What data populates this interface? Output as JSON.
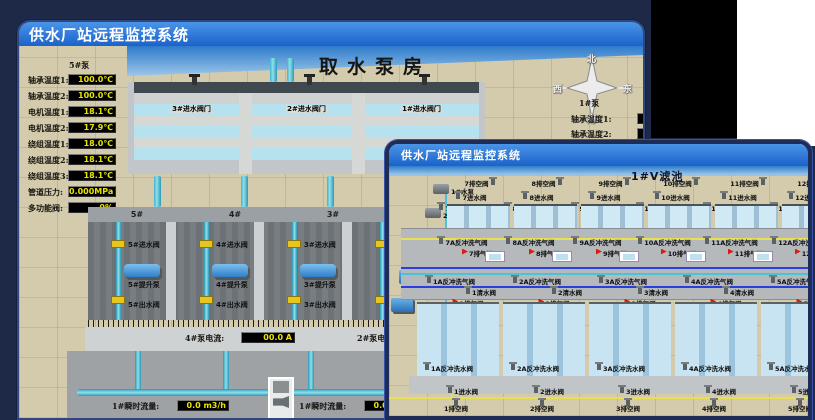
{
  "colors": {
    "page_bg": "#1e2948",
    "corner_black": "#000000",
    "corner_white": "#ffffff",
    "titlebar_top": "#4a94e8",
    "titlebar_bottom": "#1b63c9",
    "title_text": "#ffffff",
    "sand": "#d3cbac",
    "sky_top": "#2e7bca",
    "sky_bottom": "#9cc6e8",
    "value_text": "#e8e400",
    "value_bg": "#000000",
    "pipe_cyan": "#49c2da",
    "valve_yellow": "#e6c51e",
    "pump_blue": "#2f7fc8",
    "exhaust_red": "#dd1a0e",
    "water": "#cfe9f5",
    "gallery_gray": "#b5b9bc",
    "pipe_yellow": "#e8e050",
    "pipe_blue": "#2a3ee0"
  },
  "window_back": {
    "title": "供水厂站远程监控系统",
    "scene_title": "取水泵房",
    "panel": {
      "header": "5#泵",
      "rows": [
        {
          "label": "轴承温度1:",
          "value": "100.0℃"
        },
        {
          "label": "轴承温度2:",
          "value": "100.0℃"
        },
        {
          "label": "电机温度1:",
          "value": "18.1℃"
        },
        {
          "label": "电机温度2:",
          "value": "17.9℃"
        },
        {
          "label": "绕组温度1:",
          "value": "18.0℃"
        },
        {
          "label": "绕组温度2:",
          "value": "18.1℃"
        },
        {
          "label": "绕组温度3:",
          "value": "18.1℃"
        },
        {
          "label": "管道压力:",
          "value": "0.000MPa"
        },
        {
          "label": "多功能阀:",
          "value": "0%"
        }
      ]
    },
    "partial_panel": {
      "header": "1#泵",
      "rows": [
        "轴承温度1:",
        "轴承温度2:"
      ]
    },
    "compass": {
      "n": "北",
      "w": "西",
      "s": "南",
      "e": "东"
    },
    "inlet_valve_labels": [
      "3#进水阀门",
      "2#进水阀门",
      "1#进水阀门"
    ],
    "bays": [
      {
        "no": "5#",
        "inlet": "5#进水阀",
        "pump": "5#提升泵",
        "outlet": "5#出水阀"
      },
      {
        "no": "4#",
        "inlet": "4#进水阀",
        "pump": "4#提升泵",
        "outlet": "4#出水阀"
      },
      {
        "no": "3#",
        "inlet": "3#进水阀",
        "pump": "3#提升泵",
        "outlet": "3#出水阀"
      },
      {
        "no": "2#",
        "inlet": "2#进水阀",
        "pump": "2#提升泵",
        "outlet": "2#出水阀"
      }
    ],
    "current_left": {
      "label": "4#泵电流:",
      "value": "00.0 A"
    },
    "current_right": {
      "label": "2#泵电流:",
      "value": "00.0 A"
    },
    "flow_left": {
      "label": "1#瞬时流量:",
      "value": "0.0 m3/h"
    },
    "flow_right": {
      "label": "1#瞬时流量:",
      "value": "0.0 m3/h"
    }
  },
  "window_front": {
    "title": "供水厂站远程监控系统",
    "scene_title": "1#V滤池",
    "equipment_pumps": [
      "1#水泵",
      "2#水泵",
      "3#水泵"
    ],
    "equipment_fans": [
      "1#风机",
      "2#风机",
      "3#风机"
    ],
    "far_drain": [
      "7排空阀",
      "8排空阀",
      "9排空阀",
      "10排空阀",
      "11排空阀",
      "12排空阀"
    ],
    "far_inlet": [
      "7进水阀",
      "8进水阀",
      "9进水阀",
      "10进水阀",
      "11进水阀",
      "12进水阀"
    ],
    "far_wash_water": [
      "7A反冲洗水阀",
      "8A反冲洗水阀",
      "9A反冲洗水阀",
      "10A反冲洗水阀",
      "11A反冲洗水阀",
      "12A反冲洗水阀"
    ],
    "far_wash_air": [
      "7A反冲洗气阀",
      "8A反冲洗气阀",
      "9A反冲洗气阀",
      "10A反冲洗气阀",
      "11A反冲洗气阀",
      "12A反冲洗气阀"
    ],
    "far_exhaust": [
      "7排气阀",
      "8排气阀",
      "9排气阀",
      "10排气阀",
      "11排气阀",
      "12排气阀"
    ],
    "near_wash_air": [
      "1A反冲洗气阀",
      "2A反冲洗气阀",
      "3A反冲洗气阀",
      "4A反冲洗气阀",
      "5A反冲洗气阀",
      "6A反冲洗气阀"
    ],
    "near_clean": [
      "1清水阀",
      "2清水阀",
      "3清水阀",
      "4清水阀",
      "5清水阀",
      "6清水阀"
    ],
    "near_exhaust": [
      "1排气阀",
      "2排气阀",
      "3排气阀",
      "4排气阀",
      "5排气阀",
      "6排气阀"
    ],
    "near_wash_water": [
      "1A反冲洗水阀",
      "2A反冲洗水阀",
      "3A反冲洗水阀",
      "4A反冲洗水阀",
      "5A反冲洗水阀",
      "6A反冲洗水阀"
    ],
    "near_inlet": [
      "1进水阀",
      "2进水阀",
      "3进水阀",
      "4进水阀",
      "5进水阀",
      "6进水阀"
    ],
    "near_drain": [
      "1排空阀",
      "2排空阀",
      "3排空阀",
      "4排空阀",
      "5排空阀",
      "6排空阀"
    ]
  }
}
